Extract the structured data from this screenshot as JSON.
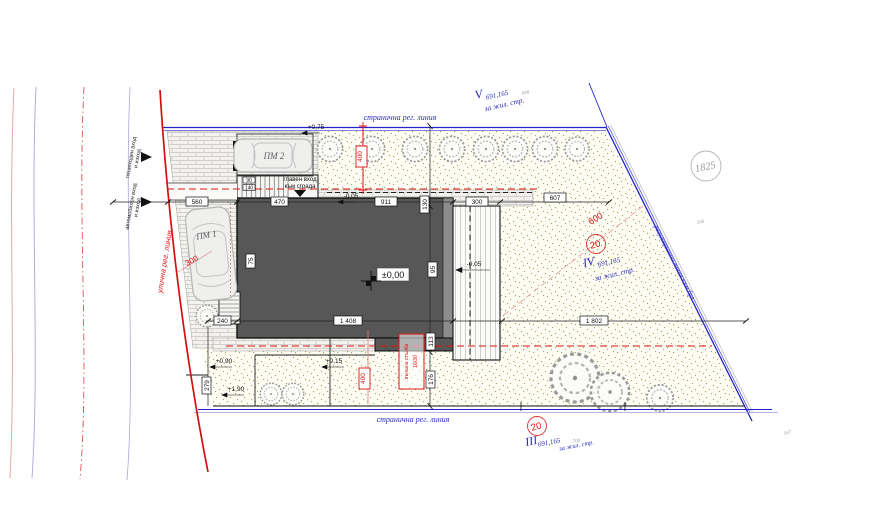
{
  "plan": {
    "labels": {
      "side_top": "странична рег. линия",
      "side_bottom": "странична рег. линия",
      "street": "улична рег. линия",
      "reg_diag": "регулационна линия към бул.",
      "ped_l1": "пешеходен вход",
      "ped_l2": "и изход",
      "veh_l1": "автомобилен вход",
      "veh_l2": "и изход",
      "main_l1": "главен вход",
      "main_l2": "към сграда",
      "pm1": "ПМ 1",
      "pm2": "ПМ 2",
      "parcel": "1825",
      "n166": "166",
      "n167": "167",
      "n698": "698",
      "n700": "700",
      "v": "V",
      "iv": "IV",
      "iii": "III",
      "v_elev": "691,165",
      "iv_elev": "691,165",
      "iii_elev": "691,165",
      "v_use": "за жил. стр.",
      "iv_use": "за жил. стр.",
      "iii_use": "за жил. стр."
    },
    "levels": {
      "zero": "±0,00",
      "minus005_top": "-0,05",
      "minus005_deck": "-0,05",
      "p075": "+0,75",
      "p090": "+0,90",
      "p015": "+0,15",
      "p190": "+1,90"
    },
    "dims": {
      "d560": "560",
      "d470": "470",
      "d911": "911",
      "d300": "300",
      "d607": "607",
      "d240": "240",
      "d1408": "1 408",
      "d1802": "1 802",
      "d130": "130",
      "d113": "113",
      "d176": "176",
      "d279": "279",
      "d75": "75",
      "d95": "95",
      "d90": "90",
      "d140": "140"
    },
    "red": {
      "r400_top": "400",
      "r400_bottom": "400",
      "r300": "300",
      "r600": "600",
      "r20_mid": "20",
      "r20_bottom": "20",
      "stair_l1": "външна стълба",
      "stair_l2": "16/30"
    },
    "colors": {
      "boundary_blue": "#2323cc",
      "regulation_red": "#d91111",
      "building_gray": "#575757",
      "grass_dot": "#8f9048",
      "label_blue": "#2a2ac0",
      "pink_dash": "#f0a8a8"
    }
  }
}
